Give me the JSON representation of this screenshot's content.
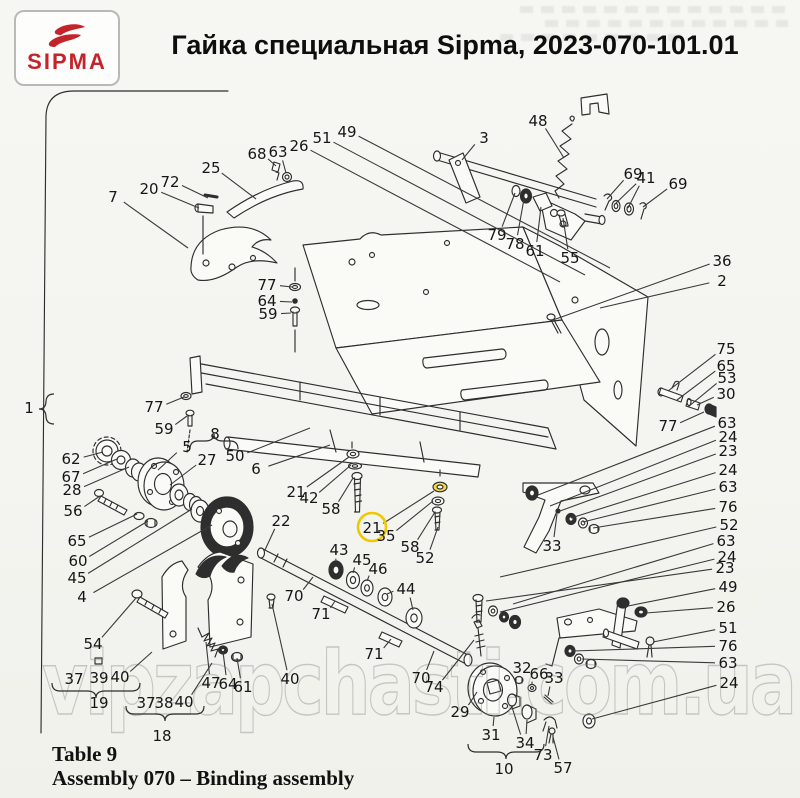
{
  "header": {
    "logo_text": "SIPMA",
    "title": "Гайка специальная Sipma, 2023-070-101.01"
  },
  "footer": {
    "table_label": "Table 9",
    "assembly_label": "Assembly 070 – Binding assembly"
  },
  "watermark": "vipzapchasti.com.ua",
  "colors": {
    "line": "#2e2e2e",
    "leader": "#3a3a3a",
    "label_text": "#161616",
    "brand_red": "#c5232b",
    "highlight_ring": "#eec900",
    "highlight_fill": "#f3d84e",
    "watermark_gray": "#8f8f8f"
  },
  "diagram": {
    "labels": [
      {
        "n": "7",
        "x": 113,
        "y": 197,
        "to": [
          188,
          248
        ]
      },
      {
        "n": "20",
        "x": 149,
        "y": 189,
        "to": [
          199,
          208
        ]
      },
      {
        "n": "72",
        "x": 170,
        "y": 182,
        "to": [
          208,
          198
        ]
      },
      {
        "n": "25",
        "x": 211,
        "y": 168,
        "to": [
          256,
          199
        ]
      },
      {
        "n": "68",
        "x": 257,
        "y": 154,
        "to": [
          276,
          166
        ]
      },
      {
        "n": "63",
        "x": 278,
        "y": 152,
        "to": [
          286,
          173
        ]
      },
      {
        "n": "26",
        "x": 299,
        "y": 146,
        "to": [
          560,
          282
        ]
      },
      {
        "n": "51",
        "x": 322,
        "y": 138,
        "to": [
          585,
          275
        ]
      },
      {
        "n": "49",
        "x": 347,
        "y": 132,
        "to": [
          610,
          268
        ]
      },
      {
        "n": "48",
        "x": 538,
        "y": 121,
        "to": [
          564,
          158
        ]
      },
      {
        "n": "3",
        "x": 484,
        "y": 138,
        "to": [
          462,
          160
        ]
      },
      {
        "n": "69",
        "x": 633,
        "y": 174,
        "to": [
          607,
          199
        ]
      },
      {
        "n": "41",
        "x": 646,
        "y": 178,
        "to": [
          614,
          205
        ],
        "to2": [
          628,
          208
        ]
      },
      {
        "n": "69",
        "x": 678,
        "y": 184,
        "to": [
          643,
          207
        ]
      },
      {
        "n": "79",
        "x": 497,
        "y": 235,
        "to": [
          515,
          193
        ]
      },
      {
        "n": "78",
        "x": 515,
        "y": 244,
        "to": [
          524,
          199
        ]
      },
      {
        "n": "61",
        "x": 535,
        "y": 251,
        "to": [
          541,
          207
        ]
      },
      {
        "n": "55",
        "x": 570,
        "y": 258,
        "to": [
          563,
          218
        ]
      },
      {
        "n": "36",
        "x": 722,
        "y": 261,
        "to": [
          553,
          320
        ]
      },
      {
        "n": "2",
        "x": 722,
        "y": 281,
        "to": [
          600,
          308
        ]
      },
      {
        "n": "77",
        "x": 267,
        "y": 285,
        "to": [
          292,
          287
        ]
      },
      {
        "n": "64",
        "x": 267,
        "y": 301,
        "to": [
          292,
          302
        ]
      },
      {
        "n": "59",
        "x": 268,
        "y": 314,
        "to": [
          291,
          313
        ]
      },
      {
        "n": "1",
        "x": 29,
        "y": 408
      },
      {
        "n": "77",
        "x": 154,
        "y": 407,
        "to": [
          184,
          397
        ]
      },
      {
        "n": "59",
        "x": 164,
        "y": 429,
        "to": [
          187,
          416
        ]
      },
      {
        "n": "8",
        "x": 215,
        "y": 434
      },
      {
        "n": "5",
        "x": 187,
        "y": 447,
        "to": [
          158,
          470
        ]
      },
      {
        "n": "27",
        "x": 207,
        "y": 460,
        "to": [
          170,
          485
        ]
      },
      {
        "n": "50",
        "x": 235,
        "y": 456,
        "to": [
          310,
          428
        ]
      },
      {
        "n": "6",
        "x": 256,
        "y": 469,
        "to": [
          330,
          445
        ]
      },
      {
        "n": "62",
        "x": 71,
        "y": 459,
        "to": [
          103,
          452
        ]
      },
      {
        "n": "67",
        "x": 71,
        "y": 477,
        "to": [
          117,
          459
        ]
      },
      {
        "n": "28",
        "x": 72,
        "y": 490,
        "to": [
          129,
          467
        ]
      },
      {
        "n": "56",
        "x": 73,
        "y": 511,
        "to": [
          100,
          496
        ]
      },
      {
        "n": "65",
        "x": 77,
        "y": 541,
        "to": [
          137,
          514
        ]
      },
      {
        "n": "60",
        "x": 78,
        "y": 561,
        "to": [
          148,
          521
        ]
      },
      {
        "n": "45",
        "x": 77,
        "y": 578,
        "to": [
          192,
          509
        ]
      },
      {
        "n": "4",
        "x": 82,
        "y": 597,
        "to": [
          212,
          525
        ]
      },
      {
        "n": "54",
        "x": 93,
        "y": 644,
        "to": [
          136,
          598
        ]
      },
      {
        "n": "22",
        "x": 281,
        "y": 521,
        "to": [
          265,
          550
        ]
      },
      {
        "n": "21",
        "x": 296,
        "y": 492,
        "to": [
          349,
          457
        ]
      },
      {
        "n": "42",
        "x": 309,
        "y": 498,
        "to": [
          351,
          465
        ]
      },
      {
        "n": "58",
        "x": 331,
        "y": 509,
        "to": [
          353,
          478
        ]
      },
      {
        "n": "21",
        "x": 372,
        "y": 528,
        "circled": true,
        "to": [
          434,
          491
        ]
      },
      {
        "n": "35",
        "x": 386,
        "y": 536,
        "to": [
          433,
          501
        ]
      },
      {
        "n": "58",
        "x": 410,
        "y": 547,
        "to": [
          435,
          512
        ]
      },
      {
        "n": "52",
        "x": 425,
        "y": 558,
        "to": [
          438,
          527
        ]
      },
      {
        "n": "43",
        "x": 339,
        "y": 550,
        "to": [
          336,
          562
        ]
      },
      {
        "n": "45",
        "x": 362,
        "y": 560,
        "to": [
          353,
          573
        ]
      },
      {
        "n": "46",
        "x": 378,
        "y": 569,
        "to": [
          367,
          581
        ]
      },
      {
        "n": "44",
        "x": 406,
        "y": 589,
        "to": [
          387,
          594
        ],
        "to2": [
          413,
          610
        ]
      },
      {
        "n": "70",
        "x": 294,
        "y": 596,
        "to": [
          313,
          577
        ]
      },
      {
        "n": "71",
        "x": 321,
        "y": 614,
        "to": [
          335,
          601
        ]
      },
      {
        "n": "71",
        "x": 374,
        "y": 654,
        "to": [
          391,
          639
        ]
      },
      {
        "n": "70",
        "x": 421,
        "y": 678,
        "to": [
          434,
          651
        ]
      },
      {
        "n": "74",
        "x": 434,
        "y": 687,
        "to": [
          474,
          640
        ]
      },
      {
        "n": "29",
        "x": 460,
        "y": 712,
        "to": [
          477,
          692
        ]
      },
      {
        "n": "31",
        "x": 491,
        "y": 735,
        "to": [
          494,
          717
        ]
      },
      {
        "n": "32",
        "x": 522,
        "y": 668,
        "to": [
          519,
          677
        ]
      },
      {
        "n": "66",
        "x": 539,
        "y": 674,
        "to": [
          532,
          685
        ]
      },
      {
        "n": "33",
        "x": 554,
        "y": 678,
        "to": [
          548,
          696
        ]
      },
      {
        "n": "34",
        "x": 525,
        "y": 743,
        "to": [
          512,
          707
        ],
        "to2": [
          527,
          720
        ]
      },
      {
        "n": "10",
        "x": 504,
        "y": 769
      },
      {
        "n": "73",
        "x": 543,
        "y": 755,
        "to": [
          549,
          726
        ]
      },
      {
        "n": "57",
        "x": 563,
        "y": 768,
        "to": [
          553,
          737
        ]
      },
      {
        "n": "75",
        "x": 726,
        "y": 349,
        "to": [
          668,
          391
        ]
      },
      {
        "n": "65",
        "x": 726,
        "y": 366,
        "to": [
          677,
          400
        ]
      },
      {
        "n": "53",
        "x": 727,
        "y": 378,
        "to": [
          688,
          407
        ]
      },
      {
        "n": "30",
        "x": 726,
        "y": 394,
        "to": [
          697,
          405
        ]
      },
      {
        "n": "77",
        "x": 668,
        "y": 426,
        "to": [
          704,
          412
        ]
      },
      {
        "n": "63",
        "x": 727,
        "y": 423,
        "to": [
          538,
          495
        ]
      },
      {
        "n": "24",
        "x": 728,
        "y": 437,
        "to": [
          550,
          506
        ]
      },
      {
        "n": "23",
        "x": 728,
        "y": 451,
        "to": [
          560,
          511
        ]
      },
      {
        "n": "24",
        "x": 728,
        "y": 470,
        "to": [
          571,
          518
        ]
      },
      {
        "n": "63",
        "x": 728,
        "y": 487,
        "to": [
          583,
          522
        ]
      },
      {
        "n": "76",
        "x": 728,
        "y": 507,
        "to": [
          593,
          528
        ]
      },
      {
        "n": "52",
        "x": 729,
        "y": 525,
        "to": [
          500,
          577
        ]
      },
      {
        "n": "33",
        "x": 552,
        "y": 546,
        "to": [
          557,
          514
        ]
      },
      {
        "n": "63",
        "x": 726,
        "y": 541,
        "to": [
          513,
          604
        ]
      },
      {
        "n": "24",
        "x": 727,
        "y": 557,
        "to": [
          500,
          612
        ]
      },
      {
        "n": "23",
        "x": 725,
        "y": 568,
        "to": [
          486,
          601
        ]
      },
      {
        "n": "49",
        "x": 728,
        "y": 587,
        "to": [
          628,
          606
        ]
      },
      {
        "n": "26",
        "x": 726,
        "y": 607,
        "to": [
          646,
          613
        ]
      },
      {
        "n": "51",
        "x": 728,
        "y": 628,
        "to": [
          653,
          642
        ]
      },
      {
        "n": "76",
        "x": 728,
        "y": 646,
        "to": [
          573,
          651
        ]
      },
      {
        "n": "63",
        "x": 728,
        "y": 663,
        "to": [
          582,
          659
        ]
      },
      {
        "n": "24",
        "x": 729,
        "y": 683,
        "to": [
          592,
          719
        ]
      },
      {
        "n": "47",
        "x": 211,
        "y": 683,
        "to": [
          206,
          642
        ]
      },
      {
        "n": "64",
        "x": 228,
        "y": 684,
        "to": [
          223,
          652
        ]
      },
      {
        "n": "61",
        "x": 243,
        "y": 687,
        "to": [
          237,
          658
        ]
      },
      {
        "n": "37",
        "x": 74,
        "y": 679
      },
      {
        "n": "39",
        "x": 99,
        "y": 678
      },
      {
        "n": "40",
        "x": 120,
        "y": 677,
        "to": [
          152,
          652
        ]
      },
      {
        "n": "19",
        "x": 99,
        "y": 703
      },
      {
        "n": "37",
        "x": 146,
        "y": 703
      },
      {
        "n": "38",
        "x": 164,
        "y": 703
      },
      {
        "n": "40",
        "x": 184,
        "y": 702,
        "to": [
          212,
          663
        ]
      },
      {
        "n": "18",
        "x": 162,
        "y": 736
      },
      {
        "n": "40",
        "x": 290,
        "y": 679,
        "to": [
          272,
          604
        ]
      }
    ],
    "braces": [
      {
        "id": "brace-19",
        "orient": "h",
        "tip": "down",
        "x1": 52,
        "x2": 140,
        "y": 688
      },
      {
        "id": "brace-18",
        "orient": "h",
        "tip": "down",
        "x1": 126,
        "x2": 204,
        "y": 711
      },
      {
        "id": "brace-10",
        "orient": "h",
        "tip": "down",
        "x1": 468,
        "x2": 544,
        "y": 749
      },
      {
        "id": "brace-8",
        "orient": "h",
        "tip": "up",
        "x1": 190,
        "x2": 238,
        "y": 444
      },
      {
        "id": "brace-1",
        "orient": "v",
        "tip": "left",
        "x": 48,
        "y1": 394,
        "y2": 424
      }
    ]
  }
}
